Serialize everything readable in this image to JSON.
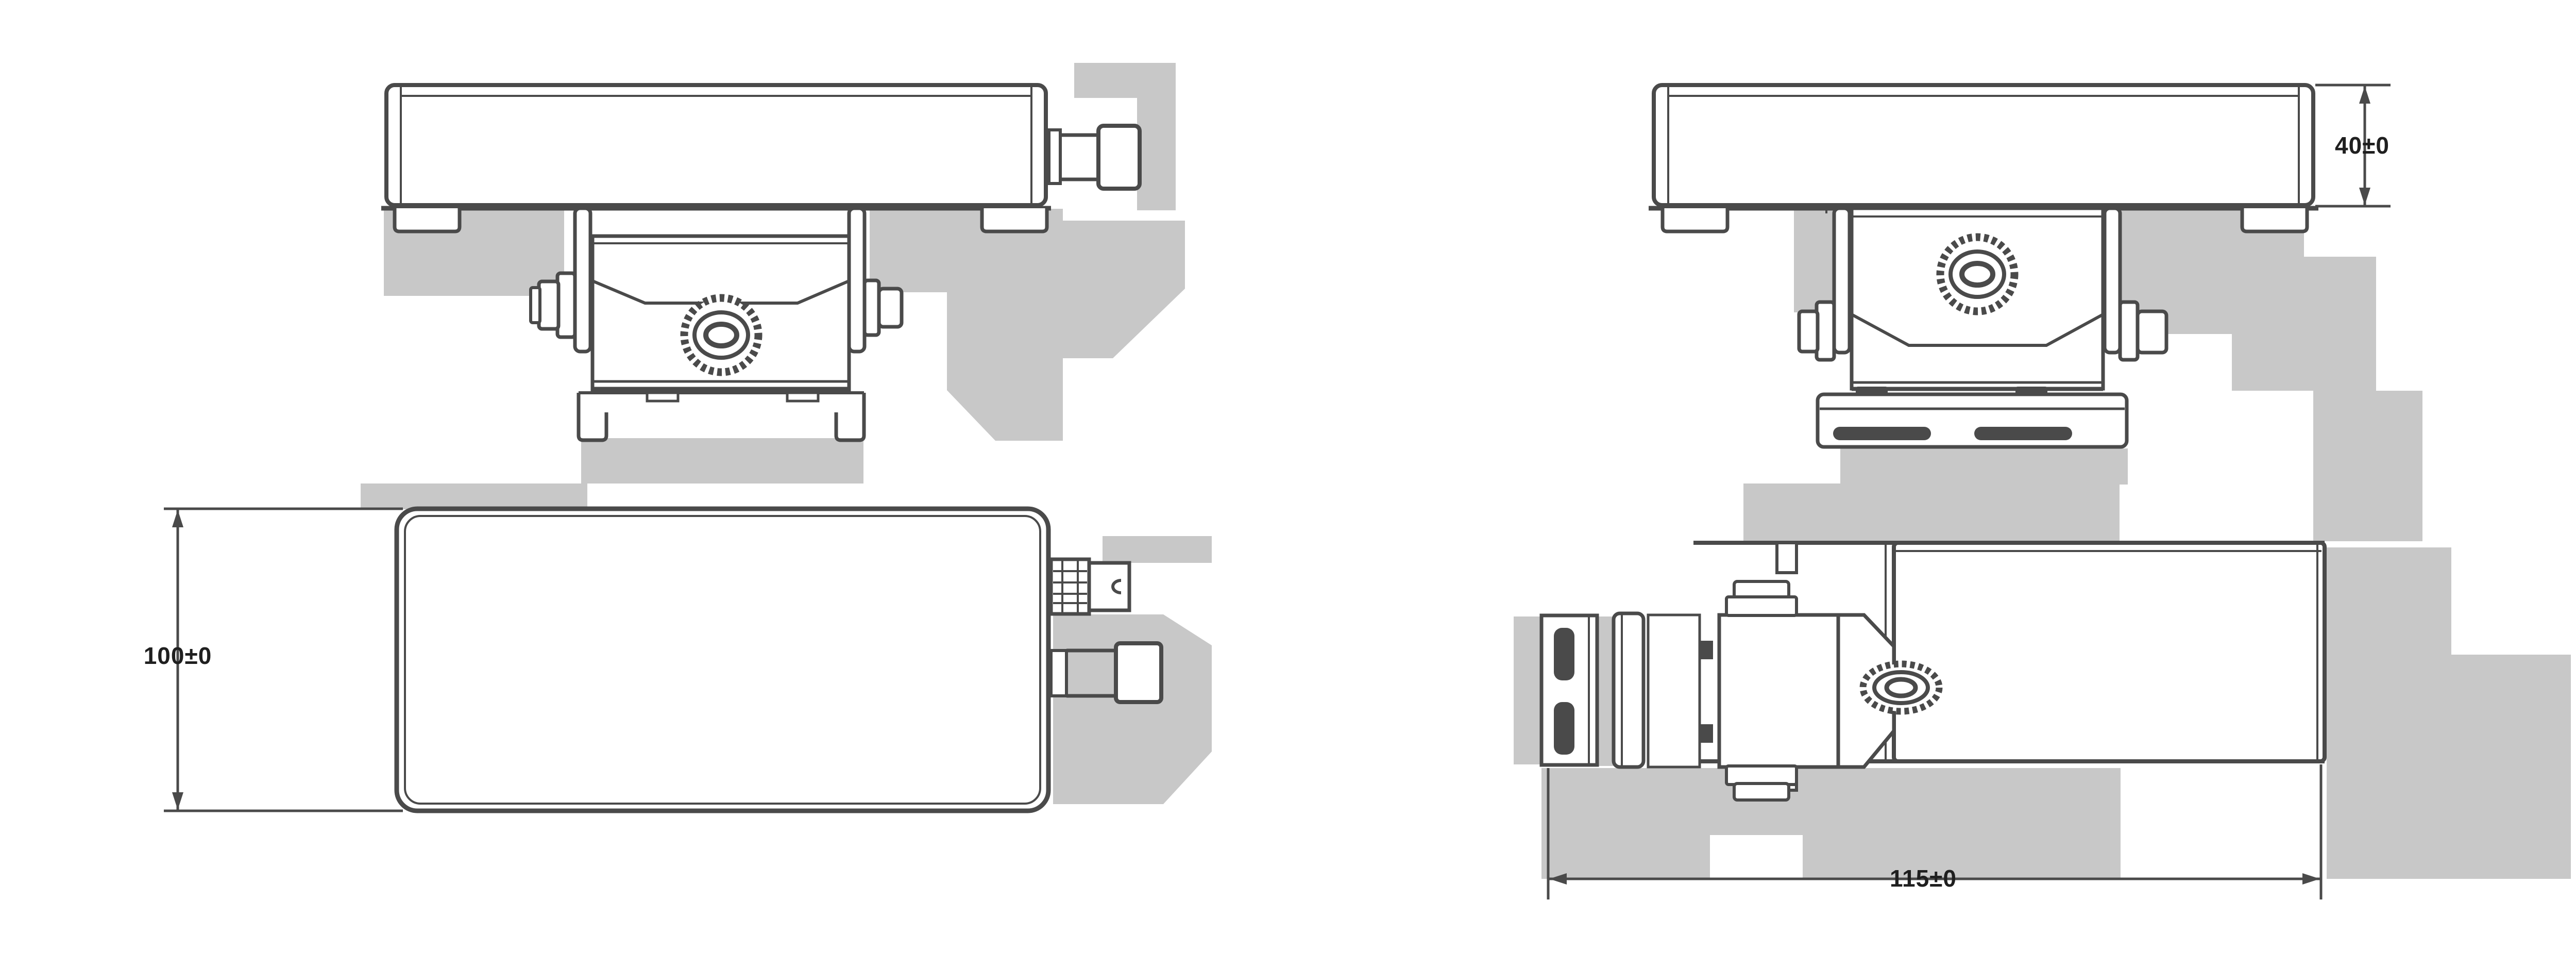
{
  "drawing": {
    "colors": {
      "bg": "#ffffff",
      "line": "#4a4a4a",
      "shadow": "#c8c8c8",
      "shadow2": "#bdbdbd",
      "text": "#1f1f1f"
    },
    "dimensions": {
      "height": {
        "label": "40±0"
      },
      "width": {
        "label": "100±0"
      },
      "depth": {
        "label": "115±0"
      }
    }
  }
}
